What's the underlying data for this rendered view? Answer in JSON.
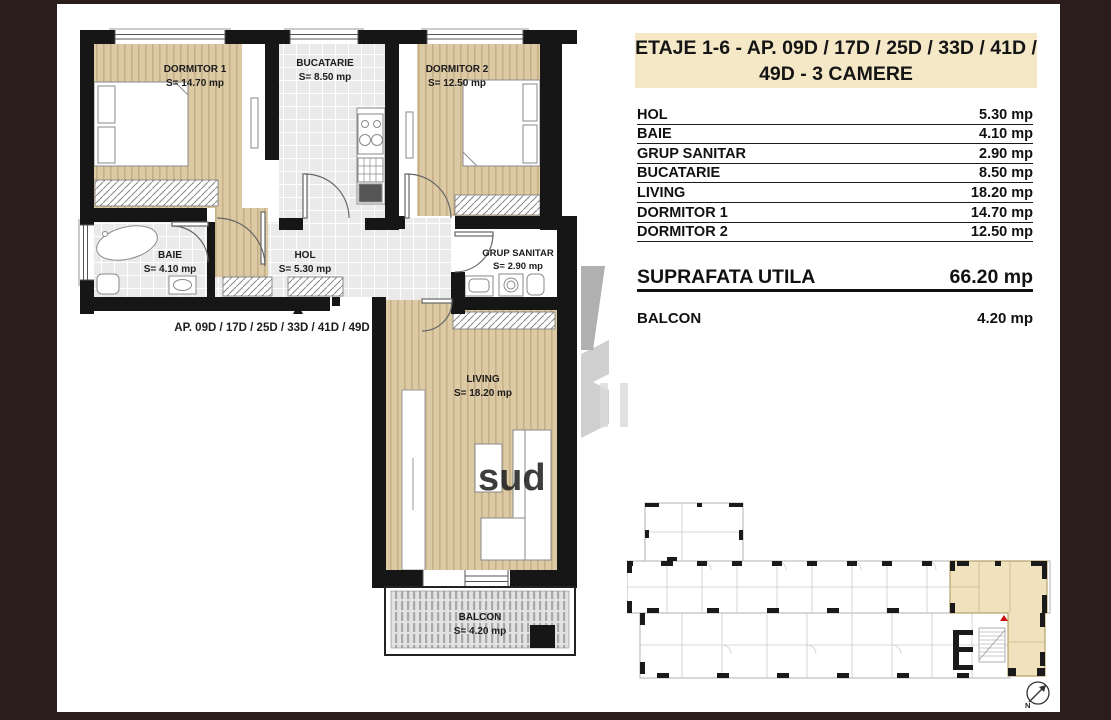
{
  "title": {
    "line1": "ETAJE 1-6 -  AP.  09D / 17D / 25D / 33D / 41D /",
    "line2": "49D   - 3 CAMERE"
  },
  "table": {
    "rows": [
      {
        "label": "HOL",
        "value": "5.30 mp"
      },
      {
        "label": "BAIE",
        "value": "4.10 mp"
      },
      {
        "label": "GRUP SANITAR",
        "value": "2.90 mp"
      },
      {
        "label": "BUCATARIE",
        "value": "8.50 mp"
      },
      {
        "label": "LIVING",
        "value": "18.20 mp"
      },
      {
        "label": "DORMITOR 1",
        "value": "14.70 mp"
      },
      {
        "label": "DORMITOR 2",
        "value": "12.50 mp"
      }
    ],
    "total": {
      "label": "SUPRAFATA UTILA",
      "value": "66.20 mp"
    },
    "balcon": {
      "label": "BALCON",
      "value": "4.20 mp"
    }
  },
  "plan": {
    "ap_label": "AP.  09D / 17D / 25D / 33D / 41D / 49D",
    "rooms": {
      "dormitor1": {
        "name": "DORMITOR 1",
        "area": "S= 14.70 mp"
      },
      "bucatarie": {
        "name": "BUCATARIE",
        "area": "S= 8.50 mp"
      },
      "dormitor2": {
        "name": "DORMITOR 2",
        "area": "S= 12.50 mp"
      },
      "baie": {
        "name": "BAIE",
        "area": "S= 4.10 mp"
      },
      "hol": {
        "name": "HOL",
        "area": "S= 5.30 mp"
      },
      "grup_sanitar": {
        "name": "GRUP SANITAR",
        "area": "S= 2.90 mp"
      },
      "living": {
        "name": "LIVING",
        "area": "S= 18.20 mp"
      },
      "balcon": {
        "name": "BALCON",
        "area": "S= 4.20 mp"
      }
    }
  },
  "overview": {
    "compass_label": "N",
    "highlight_color": "#f0e2bc",
    "marker_color": "#cc1111"
  },
  "watermark": {
    "text": "sud"
  },
  "colors": {
    "frame": "#2b1d1b",
    "title_bg": "#f4e8c7",
    "wall": "#161616",
    "wood": "#dccaa4",
    "tile": "#eaeaea"
  }
}
